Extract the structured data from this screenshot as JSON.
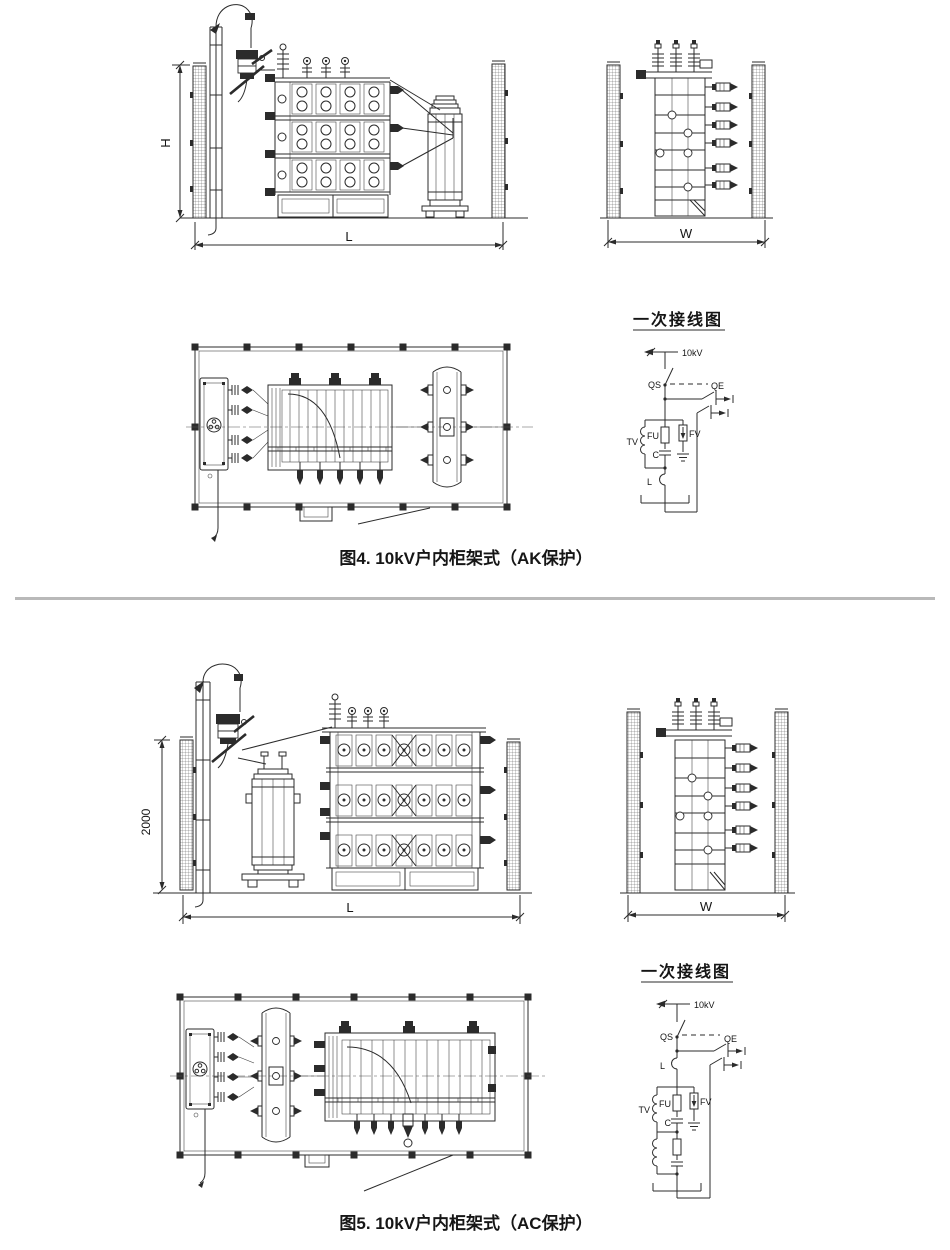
{
  "page": {
    "background": "#ffffff",
    "line_color": "#2b2b2b",
    "divider_color": "#b9b9b9"
  },
  "figures": [
    {
      "caption": "图4. 10kV户内柜架式（AK保护）",
      "dims": {
        "height": "H",
        "length": "L",
        "width": "W"
      },
      "wiring": {
        "title": "一次接线图",
        "voltage_label": "10kV",
        "disconnector": "QS",
        "earthing_switch": "QE",
        "voltage_transformer": "TV",
        "fuse": "FU",
        "capacitor": "C",
        "arrester": "FV",
        "reactor": "L"
      }
    },
    {
      "caption": "图5. 10kV户内柜架式（AC保护）",
      "dims": {
        "height": "2000",
        "length": "L",
        "width": "W"
      },
      "wiring": {
        "title": "一次接线图",
        "voltage_label": "10kV",
        "disconnector": "QS",
        "earthing_switch": "QE",
        "voltage_transformer": "TV",
        "fuse": "FU",
        "capacitor": "C",
        "arrester": "FV",
        "reactor": "L"
      }
    }
  ]
}
